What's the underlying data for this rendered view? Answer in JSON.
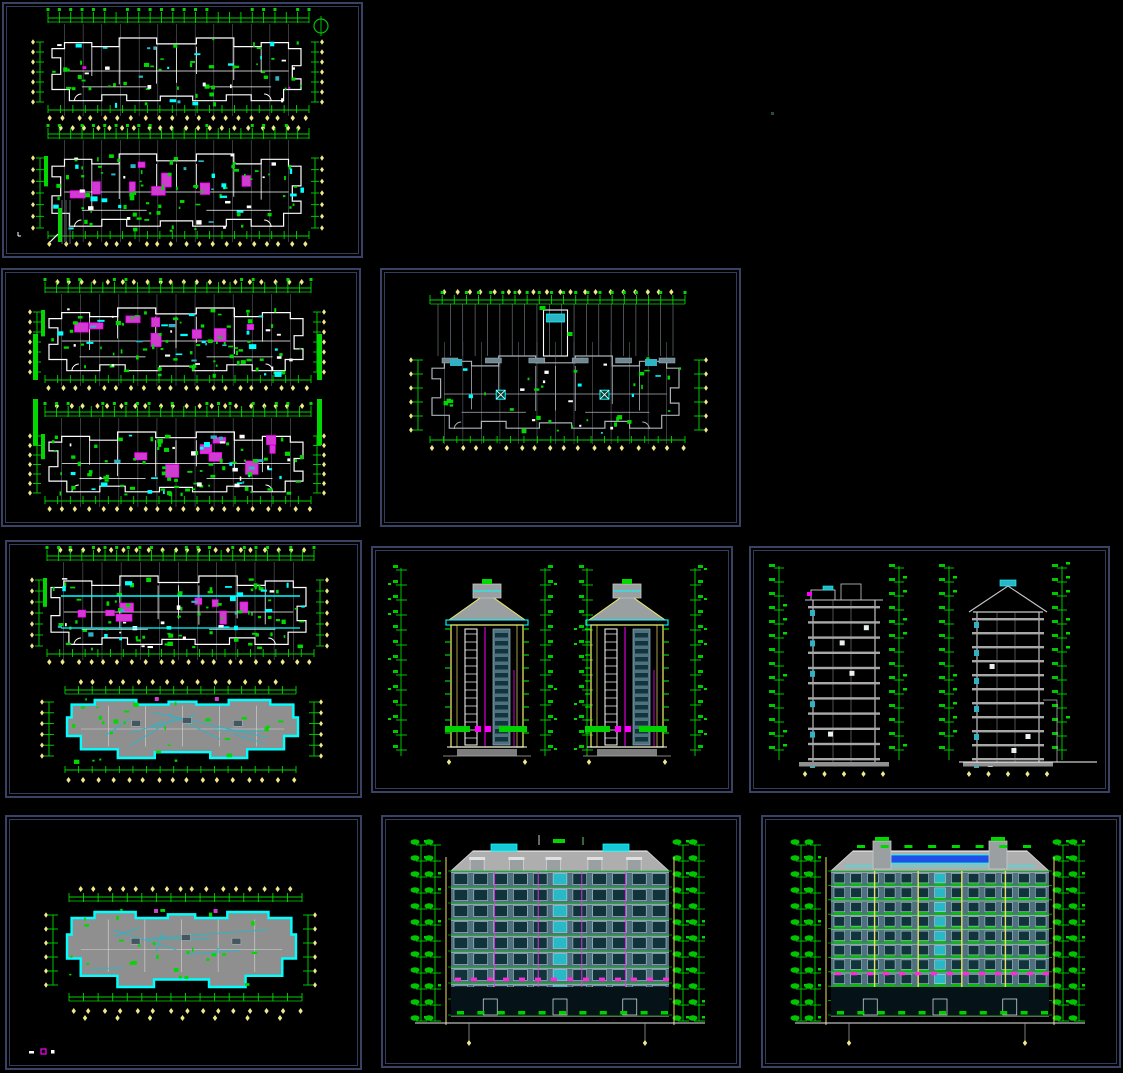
{
  "app": {
    "name": "cad-drawing-sheet-grid",
    "description": "Black-background CAD viewer showing nine drawing sheets of a residential tower: floor plans, roof plans, side elevations, sections and front/rear elevations"
  },
  "palette": {
    "background": "#000000",
    "viewport_border": "#3a4263",
    "green": "#00d800",
    "bright_green": "#00ff00",
    "cyan": "#00ffff",
    "teal": "#2fb3c4",
    "magenta": "#ff00ff",
    "violet": "#cf3ccf",
    "tick_yellow": "#efe98c",
    "pale_yellow": "#e8e263",
    "white": "#ffffff",
    "gray": "#9aa2a8",
    "roof_gray": "#aeaeae",
    "facade_slate": "#4f707e",
    "window_dark": "#10333c",
    "blue_band": "#1e50e8"
  },
  "panels": [
    {
      "id": "pA",
      "name": "sheet-floor-plans-1",
      "type": "plan-pair",
      "seed": 11,
      "has_north_arrow": true
    },
    {
      "id": "pB",
      "name": "sheet-floor-plans-2",
      "type": "plan-pair-color",
      "seed": 22
    },
    {
      "id": "pC",
      "name": "sheet-floor-plan-single",
      "type": "plan-single",
      "seed": 33
    },
    {
      "id": "pD",
      "name": "sheet-plan-and-roof",
      "type": "plan-roof",
      "seed": 44
    },
    {
      "id": "pE",
      "name": "sheet-side-elevations",
      "type": "tower-elevations",
      "seed": 55
    },
    {
      "id": "pF",
      "name": "sheet-sections",
      "type": "sections",
      "seed": 66
    },
    {
      "id": "pG",
      "name": "sheet-roof-plan",
      "type": "roof-plan",
      "seed": 77
    },
    {
      "id": "pH",
      "name": "sheet-front-elevation",
      "type": "front-elevation",
      "seed": 88
    },
    {
      "id": "pI",
      "name": "sheet-rear-elevation",
      "type": "rear-elevation-blue",
      "seed": 99
    }
  ]
}
